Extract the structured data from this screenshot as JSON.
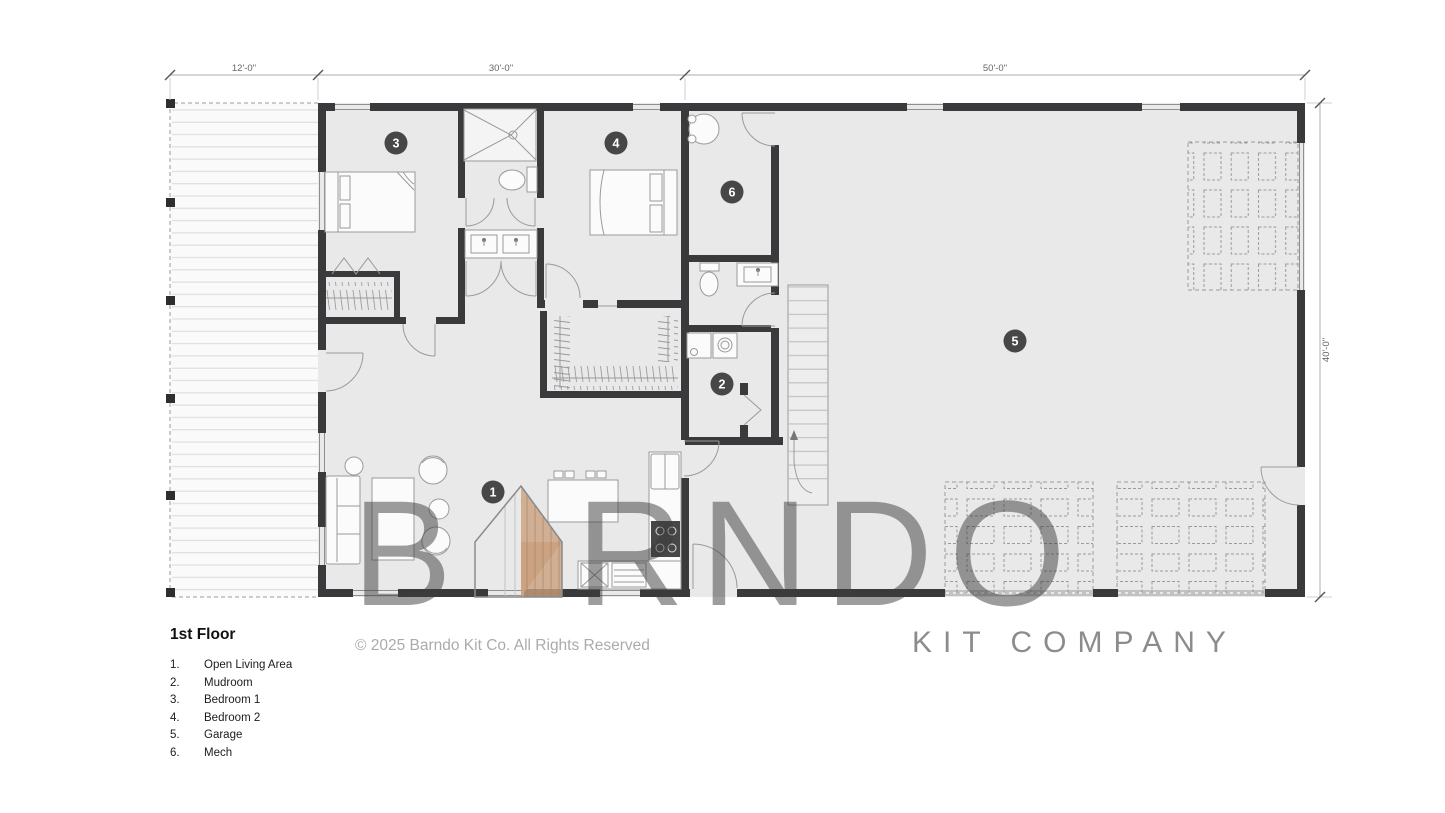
{
  "legend": {
    "title": "1st Floor",
    "items": [
      {
        "num": "1.",
        "name": "Open Living Area"
      },
      {
        "num": "2.",
        "name": "Mudroom"
      },
      {
        "num": "3.",
        "name": "Bedroom 1"
      },
      {
        "num": "4.",
        "name": "Bedroom 2"
      },
      {
        "num": "5.",
        "name": "Garage"
      },
      {
        "num": "6.",
        "name": "Mech"
      }
    ]
  },
  "dimensions": {
    "top": [
      "12'-0\"",
      "30'-0\"",
      "50'-0\""
    ],
    "right": "40'-0\""
  },
  "markers": {
    "m1": "1",
    "m2": "2",
    "m3": "3",
    "m4": "4",
    "m5": "5",
    "m6": "6"
  },
  "watermark": {
    "brand_prefix": "B",
    "brand_suffix": "RNDO",
    "subtitle": "KIT COMPANY"
  },
  "copyright": "© 2025 Barndo Kit Co. All Rights Reserved",
  "colors": {
    "wall": "#3a3a3c",
    "floor": "#e9e9ea",
    "marker": "#474747",
    "brand_gray": "#3c3c3c",
    "brand_tan": "#c9a07e"
  }
}
